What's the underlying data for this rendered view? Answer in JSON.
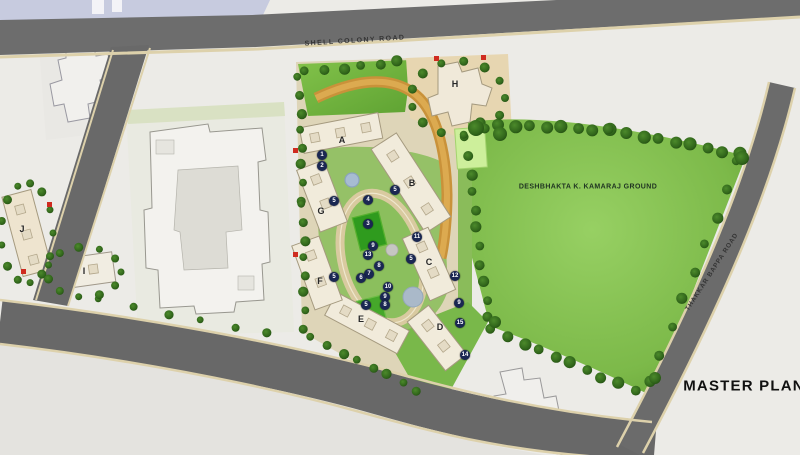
{
  "title": "MASTER PLAN",
  "roads": {
    "top_label": "SHELL COLONY ROAD",
    "right_label": "THAKKAR BAPPA ROAD"
  },
  "ground_label": "DESHBHAKTA K. KAMARAJ GROUND",
  "buildings": [
    {
      "letter": "A",
      "x": 342,
      "y": 140
    },
    {
      "letter": "B",
      "x": 412,
      "y": 183
    },
    {
      "letter": "C",
      "x": 429,
      "y": 262
    },
    {
      "letter": "D",
      "x": 440,
      "y": 327
    },
    {
      "letter": "E",
      "x": 361,
      "y": 319
    },
    {
      "letter": "F",
      "x": 320,
      "y": 281
    },
    {
      "letter": "G",
      "x": 321,
      "y": 211
    },
    {
      "letter": "H",
      "x": 455,
      "y": 84
    },
    {
      "letter": "I",
      "x": 84,
      "y": 271
    },
    {
      "letter": "J",
      "x": 22,
      "y": 229
    }
  ],
  "markers": [
    {
      "n": "1",
      "x": 322,
      "y": 155
    },
    {
      "n": "2",
      "x": 322,
      "y": 166
    },
    {
      "n": "5",
      "x": 395,
      "y": 190
    },
    {
      "n": "4",
      "x": 368,
      "y": 200
    },
    {
      "n": "5",
      "x": 334,
      "y": 201
    },
    {
      "n": "3",
      "x": 368,
      "y": 224
    },
    {
      "n": "11",
      "x": 417,
      "y": 237
    },
    {
      "n": "9",
      "x": 373,
      "y": 246
    },
    {
      "n": "13",
      "x": 368,
      "y": 255
    },
    {
      "n": "5",
      "x": 411,
      "y": 259
    },
    {
      "n": "8",
      "x": 379,
      "y": 266
    },
    {
      "n": "7",
      "x": 369,
      "y": 274
    },
    {
      "n": "6",
      "x": 361,
      "y": 278
    },
    {
      "n": "5",
      "x": 334,
      "y": 277
    },
    {
      "n": "12",
      "x": 455,
      "y": 276
    },
    {
      "n": "10",
      "x": 388,
      "y": 287
    },
    {
      "n": "9",
      "x": 385,
      "y": 297
    },
    {
      "n": "8",
      "x": 385,
      "y": 305
    },
    {
      "n": "5",
      "x": 366,
      "y": 305
    },
    {
      "n": "9",
      "x": 459,
      "y": 303
    },
    {
      "n": "15",
      "x": 460,
      "y": 323
    },
    {
      "n": "14",
      "x": 465,
      "y": 355
    }
  ],
  "colors": {
    "marker": "#1a2752",
    "road": "#6d6d6d",
    "ground_green": "#79b545",
    "accent_red": "#cf2b20"
  }
}
